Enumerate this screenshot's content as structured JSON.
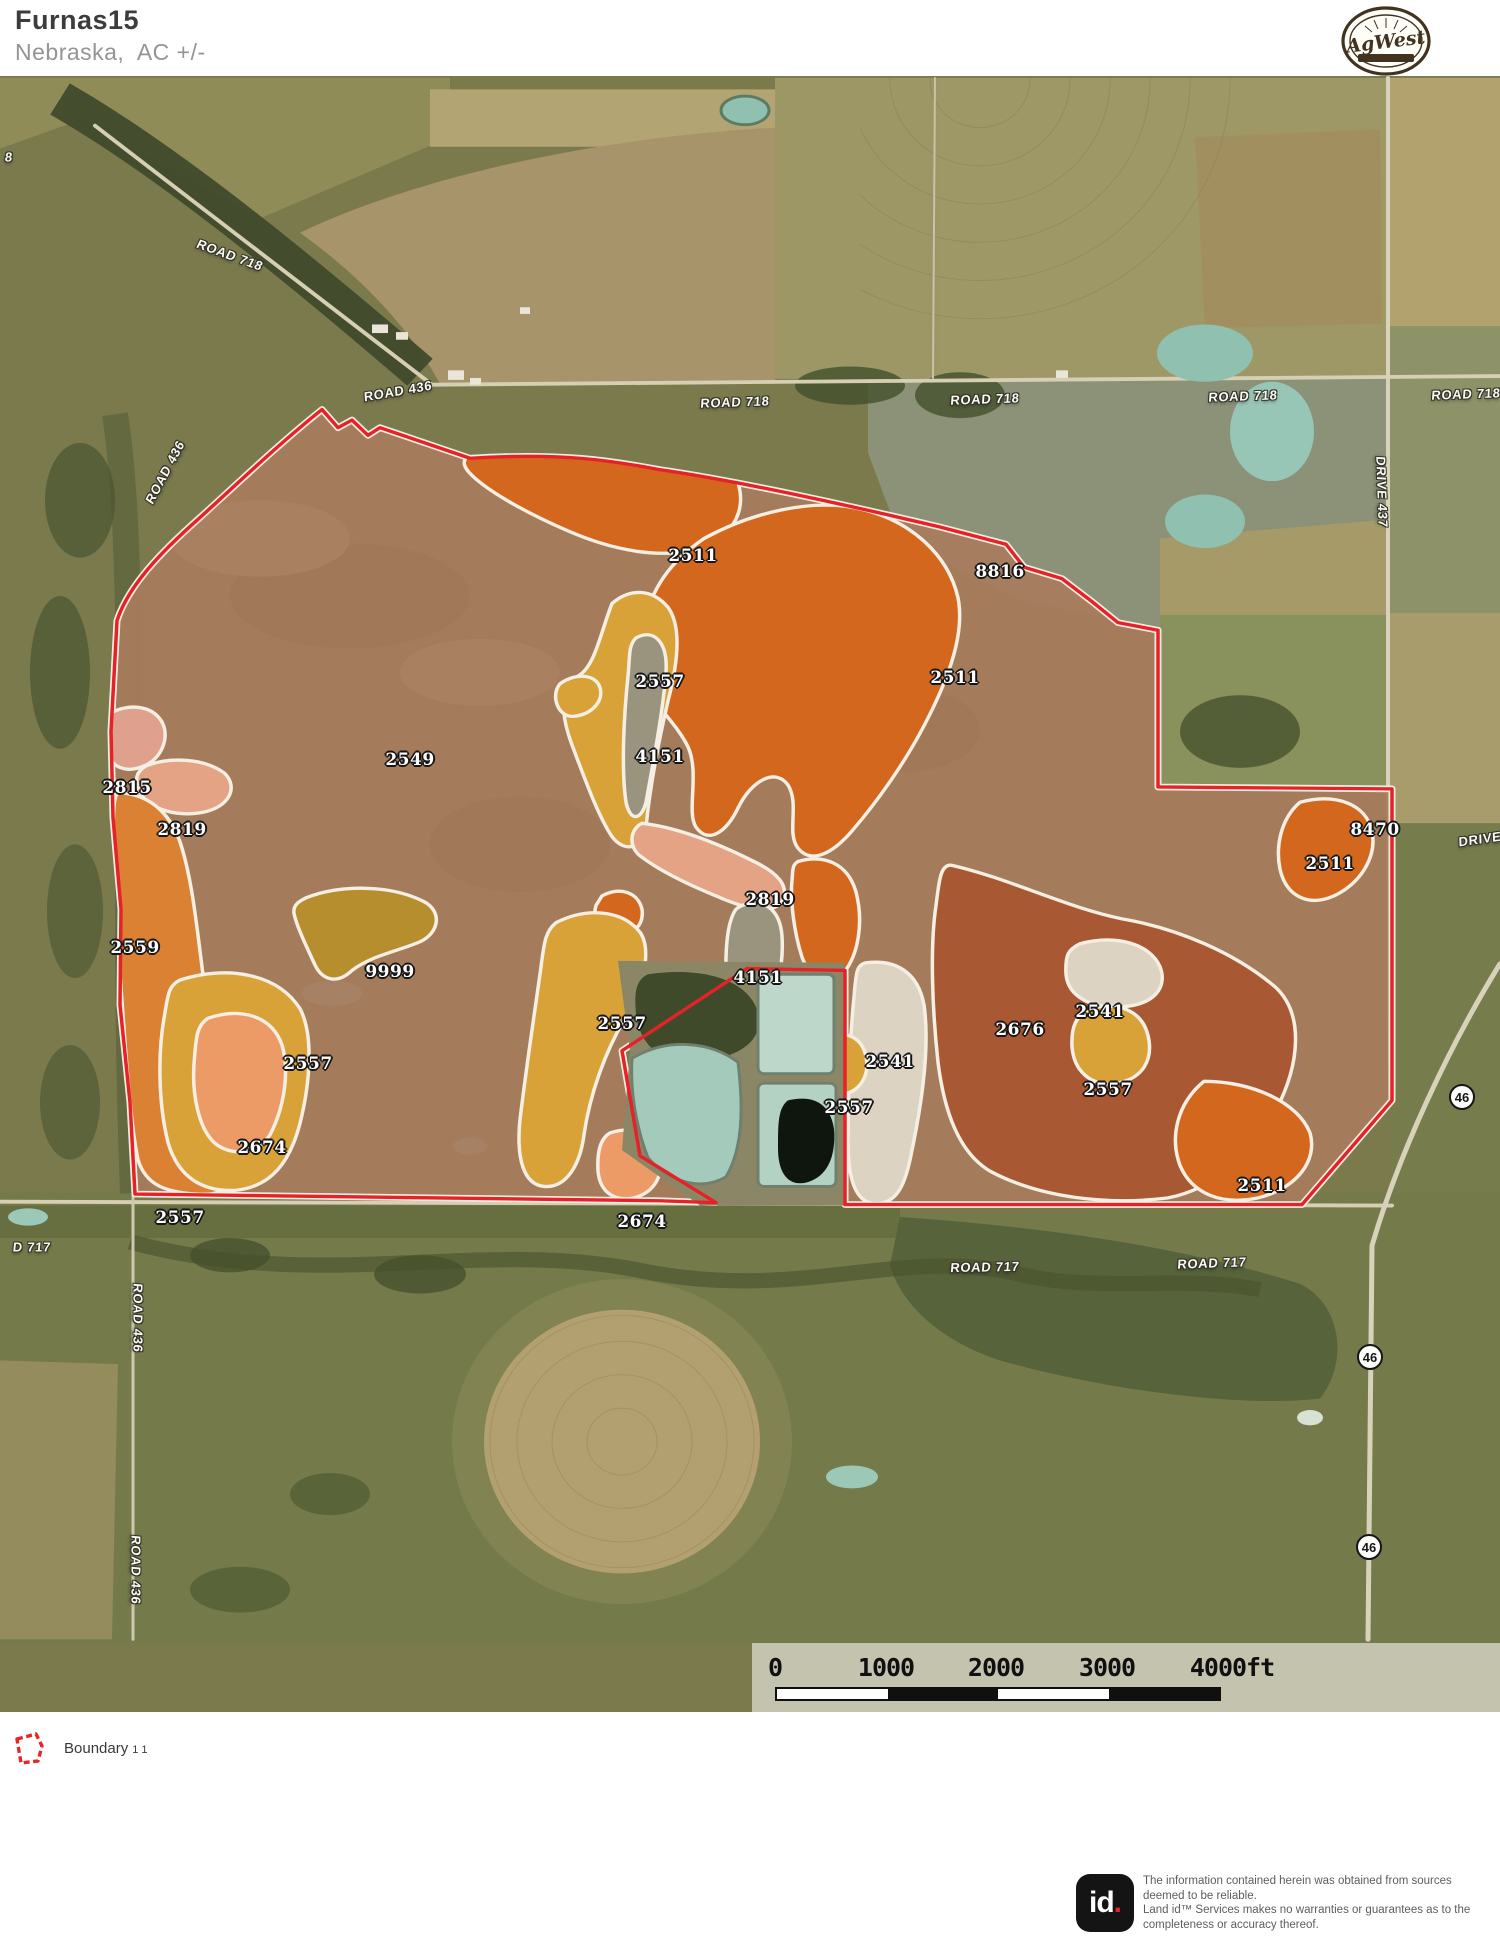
{
  "header": {
    "title": "Furnas15",
    "subtitle": "Nebraska,  AC +/-"
  },
  "logo": {
    "text": "AgWest"
  },
  "map": {
    "soil_labels": [
      {
        "value": "2511",
        "x": 693,
        "y": 556
      },
      {
        "value": "8816",
        "x": 1000,
        "y": 572
      },
      {
        "value": "2557",
        "x": 660,
        "y": 682
      },
      {
        "value": "2511",
        "x": 955,
        "y": 678
      },
      {
        "value": "4151",
        "x": 660,
        "y": 757
      },
      {
        "value": "2549",
        "x": 410,
        "y": 760
      },
      {
        "value": "2815",
        "x": 127,
        "y": 788
      },
      {
        "value": "2819",
        "x": 182,
        "y": 830
      },
      {
        "value": "8470",
        "x": 1375,
        "y": 830
      },
      {
        "value": "2511",
        "x": 1330,
        "y": 864
      },
      {
        "value": "2819",
        "x": 770,
        "y": 900
      },
      {
        "value": "2559",
        "x": 135,
        "y": 948
      },
      {
        "value": "9999",
        "x": 390,
        "y": 972
      },
      {
        "value": "4151",
        "x": 758,
        "y": 978
      },
      {
        "value": "2557",
        "x": 622,
        "y": 1024
      },
      {
        "value": "2541",
        "x": 1100,
        "y": 1012
      },
      {
        "value": "2676",
        "x": 1020,
        "y": 1030
      },
      {
        "value": "2541",
        "x": 890,
        "y": 1062
      },
      {
        "value": "2557",
        "x": 308,
        "y": 1064
      },
      {
        "value": "2557",
        "x": 1108,
        "y": 1090
      },
      {
        "value": "2557",
        "x": 849,
        "y": 1108
      },
      {
        "value": "2674",
        "x": 262,
        "y": 1148
      },
      {
        "value": "2511",
        "x": 1262,
        "y": 1186
      },
      {
        "value": "2557",
        "x": 180,
        "y": 1218
      },
      {
        "value": "2674",
        "x": 642,
        "y": 1222
      }
    ],
    "road_labels": [
      {
        "text": "8",
        "x": 9,
        "y": 157,
        "rotate": 0
      },
      {
        "text": "ROAD 718",
        "x": 230,
        "y": 255,
        "rotate": 20
      },
      {
        "text": "ROAD 436",
        "x": 398,
        "y": 391,
        "rotate": -10
      },
      {
        "text": "ROAD 718",
        "x": 735,
        "y": 402,
        "rotate": -2
      },
      {
        "text": "ROAD 718",
        "x": 985,
        "y": 399,
        "rotate": -2
      },
      {
        "text": "ROAD 718",
        "x": 1243,
        "y": 396,
        "rotate": -2
      },
      {
        "text": "ROAD 718",
        "x": 1466,
        "y": 394,
        "rotate": -2
      },
      {
        "text": "ROAD 436",
        "x": 165,
        "y": 472,
        "rotate": -62
      },
      {
        "text": "DRIVE 437",
        "x": 1382,
        "y": 492,
        "rotate": 88
      },
      {
        "text": "DRIVE",
        "x": 1480,
        "y": 839,
        "rotate": -8
      },
      {
        "text": "ROAD 717",
        "x": 985,
        "y": 1267,
        "rotate": -1
      },
      {
        "text": "ROAD 717",
        "x": 1212,
        "y": 1263,
        "rotate": -2
      },
      {
        "text": "D 717",
        "x": 32,
        "y": 1247,
        "rotate": 0
      },
      {
        "text": "ROAD 436",
        "x": 138,
        "y": 1318,
        "rotate": 90
      },
      {
        "text": "ROAD 436",
        "x": 136,
        "y": 1570,
        "rotate": 90
      }
    ],
    "highway_badges": [
      {
        "text": "46",
        "x": 1462,
        "y": 1097
      },
      {
        "text": "46",
        "x": 1370,
        "y": 1357
      },
      {
        "text": "46",
        "x": 1369,
        "y": 1547
      }
    ]
  },
  "scalebar": {
    "ticks": [
      "0",
      "1000",
      "2000",
      "3000",
      "4000ft"
    ]
  },
  "legend": {
    "label": "Boundary",
    "suffix": "1 1"
  },
  "footer": {
    "logo_text": "id",
    "logo_dot": ".",
    "disclaimer_line1": "The information contained herein was obtained from sources deemed to be reliable.",
    "disclaimer_line2": "Land id™ Services makes no warranties or guarantees as to the completeness or accuracy thereof."
  },
  "colors": {
    "boundary_red": "#e62228",
    "soil_outline_white": "#f4efe2",
    "parcel_fill_2549": "#a87c5c",
    "soil_2511": "#d4671e",
    "soil_2557": "#d9a238",
    "soil_4151": "#9a947e",
    "soil_2819": "#e3a384",
    "soil_2815": "#dfa08e",
    "soil_2559": "#db8134",
    "soil_9999": "#b68e2e",
    "soil_2674": "#ec9a66",
    "soil_2676": "#a85832",
    "soil_2541": "#ddd3c2"
  }
}
